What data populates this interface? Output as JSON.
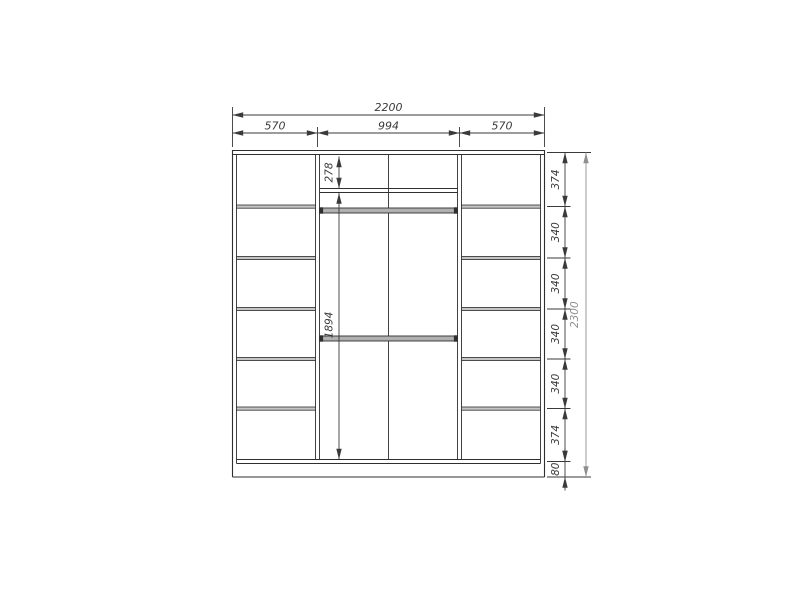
{
  "meta": {
    "drawing_type": "wardrobe front elevation dimension drawing",
    "background_color": "#ffffff",
    "outline_color": "#2f2f2f",
    "dimension_color": "#3a3a3a",
    "muted_dimension_color": "#8f8f8f",
    "shelf_fill_color": "#c4c4c4",
    "rod_fill_color": "#b0b0b0"
  },
  "dimensions": {
    "width": {
      "total": "2200",
      "left": "570",
      "middle": "994",
      "right": "570"
    },
    "height": {
      "total": "2300",
      "segments": [
        "374",
        "340",
        "340",
        "340",
        "340",
        "374",
        "80"
      ]
    },
    "interior": {
      "top_shelf": "278",
      "hanging": "1894"
    }
  }
}
